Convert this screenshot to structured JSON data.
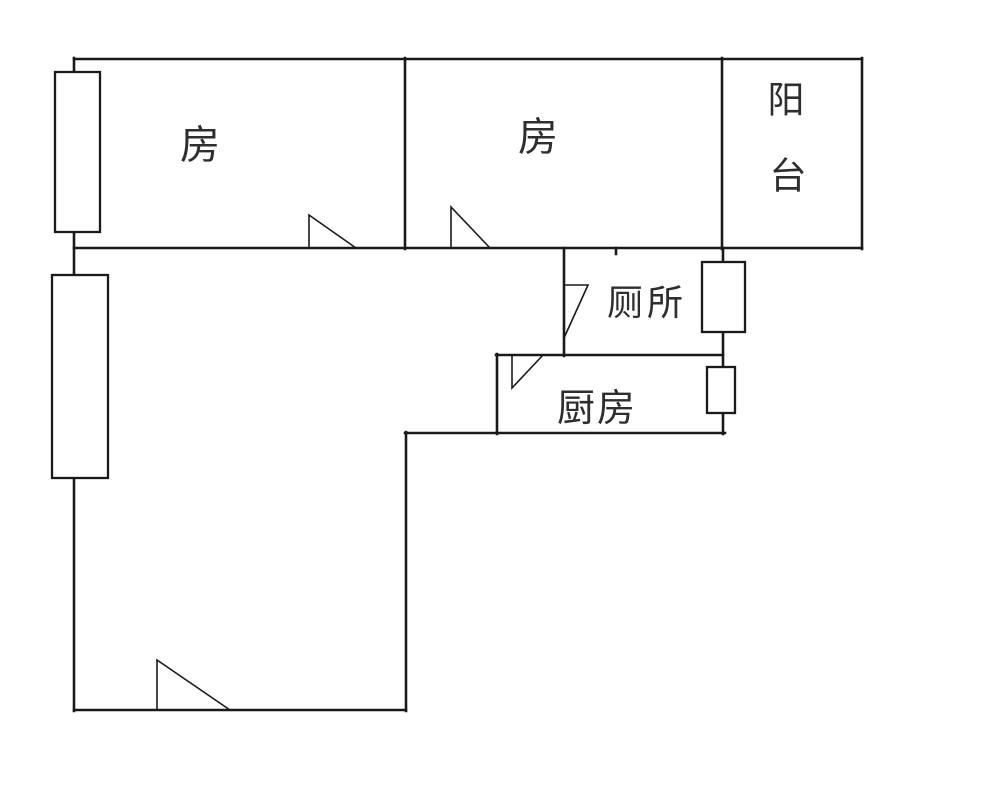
{
  "floorplan": {
    "labels": {
      "bedroom1": "房",
      "bedroom2": "房",
      "balcony": "阳台",
      "balcony_chars": [
        "阳",
        "台"
      ],
      "toilet": "厕所",
      "kitchen": "厨房"
    },
    "colors": {
      "wall": "#1a1a1a",
      "label_text": "#2e2e2e",
      "background": "#ffffff"
    }
  }
}
